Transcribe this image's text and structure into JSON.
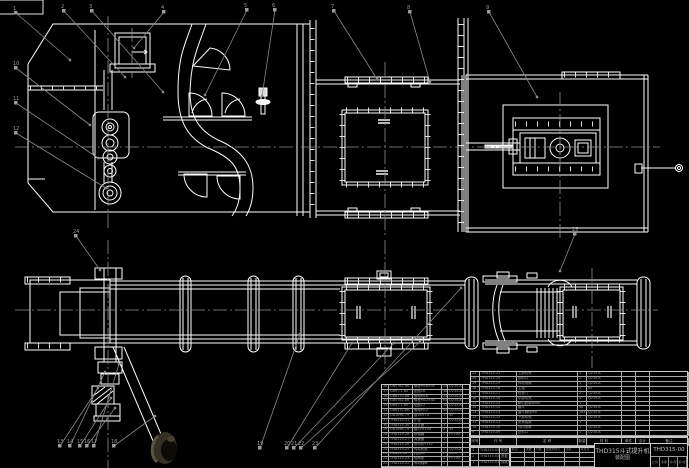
{
  "sheet": {
    "background": "#000000",
    "line_color": "#ffffff",
    "centerline_color": "#909090",
    "text_color": "#9c9c9c"
  },
  "title_block": {
    "product_name": "THD315斗式提升机",
    "drawing_type": "装配图",
    "drawing_number": "THD315-00",
    "extra_cells": [
      "比例",
      "重量",
      "共1张",
      "第1张"
    ]
  },
  "bom": {
    "header_row": [
      [
        "序号",
        "代  号",
        "名    称",
        "数量",
        "材  料",
        "单件",
        "总计",
        "备注"
      ]
    ],
    "left_rows": [
      [
        "38",
        "GB5782-86",
        "螺栓M16×45",
        "24",
        "Q235-A",
        ""
      ],
      [
        "37",
        "GB97.1-85",
        "垫圈16",
        "48",
        "Q235-A",
        ""
      ],
      [
        "36",
        "GB6170-86",
        "螺母M16",
        "24",
        "Q235-A",
        ""
      ],
      [
        "35",
        "GB5782-86",
        "螺栓M12×40",
        "60",
        "Q235-A",
        ""
      ],
      [
        "34",
        "GB97.1-85",
        "垫圈12",
        "120",
        "Q235-A",
        ""
      ],
      [
        "33",
        "GB6170-86",
        "螺母M12",
        "60",
        "Q235-A",
        ""
      ],
      [
        "32",
        "GB1096-79",
        "键18×70",
        "1",
        "45",
        ""
      ],
      [
        "31",
        "THD315-31",
        "护罩",
        "1",
        "Q235-A",
        ""
      ],
      [
        "30",
        "THD315-30",
        "逆止器",
        "1",
        "",
        ""
      ],
      [
        "29",
        "GB1096-79",
        "键22×100",
        "2",
        "45",
        ""
      ],
      [
        "28",
        "THD315-28",
        "联轴器",
        "1",
        "HT200",
        ""
      ],
      [
        "27",
        "THD315-27",
        "减速器",
        "1",
        "",
        ""
      ],
      [
        "26",
        "THD315-26",
        "电动机Y132",
        "1",
        "",
        ""
      ],
      [
        "25",
        "THD315-25",
        "传动底座",
        "1",
        "Q235-A",
        ""
      ],
      [
        "24",
        "GB893-86",
        "挡圈62",
        "2",
        "65Mn",
        ""
      ],
      [
        "23",
        "THD315-23",
        "轴承座",
        "2",
        "HT200",
        ""
      ],
      [
        "22",
        "THD315-22",
        "滚动轴承",
        "2",
        "",
        ""
      ]
    ],
    "right_rows": [
      [
        "21",
        "THD315-21",
        "上部机壳",
        "1",
        "Q235-A",
        "",
        "",
        ""
      ],
      [
        "20",
        "THD315-20",
        "卸料口",
        "1",
        "Q235-A",
        "",
        "",
        ""
      ],
      [
        "19",
        "THD315-19",
        "传动滚筒",
        "1",
        "Q235-A",
        "",
        "",
        ""
      ],
      [
        "18",
        "THD315-18",
        "主轴",
        "1",
        "45",
        "",
        "",
        ""
      ],
      [
        "17",
        "THD315-17",
        "检视门",
        "2",
        "Q235-A",
        "",
        "",
        ""
      ],
      [
        "16",
        "THD315-16",
        "中部机壳",
        "4",
        "Q235-A",
        "",
        "",
        ""
      ],
      [
        "15",
        "THD315-15",
        "牵引胶带B500",
        "1",
        "",
        "",
        "",
        ""
      ],
      [
        "14",
        "THD315-14",
        "畚斗",
        "46",
        "Q235-A",
        "",
        "",
        ""
      ],
      [
        "13",
        "THD315-13",
        "畚斗螺栓M8",
        "184",
        "Q235-A",
        "",
        "",
        ""
      ],
      [
        "12",
        "THD315-12",
        "下部机壳",
        "1",
        "Q235-A",
        "",
        "",
        ""
      ],
      [
        "11",
        "THD315-11",
        "张紧装置",
        "1",
        "",
        "",
        "",
        ""
      ],
      [
        "10",
        "THD315-10",
        "改向滚筒",
        "1",
        "Q235-A",
        "",
        "",
        ""
      ],
      [
        "9",
        "THD315-09",
        "进料口",
        "1",
        "Q235-A",
        "",
        "",
        ""
      ]
    ],
    "extra_rows": [
      [
        "3",
        "THD315-03",
        "机座"
      ],
      [
        "2",
        "THD315-02",
        "底板"
      ],
      [
        "1",
        "THD315-01",
        "观察门"
      ]
    ],
    "signature_rows": [
      [
        "标记",
        "处数",
        "分区",
        "更改文件号",
        "签名",
        "年月日"
      ],
      [
        "",
        "",
        "",
        "",
        "",
        ""
      ],
      [
        "",
        "",
        "",
        "",
        "",
        ""
      ],
      [
        "",
        "",
        "",
        "",
        "",
        ""
      ]
    ]
  },
  "callouts": [
    "1",
    "2",
    "3",
    "4",
    "5",
    "6",
    "7",
    "8",
    "9",
    "10",
    "11",
    "12",
    "13",
    "14",
    "15",
    "16",
    "17",
    "18",
    "19",
    "20",
    "21",
    "22",
    "23",
    "24",
    "25"
  ]
}
